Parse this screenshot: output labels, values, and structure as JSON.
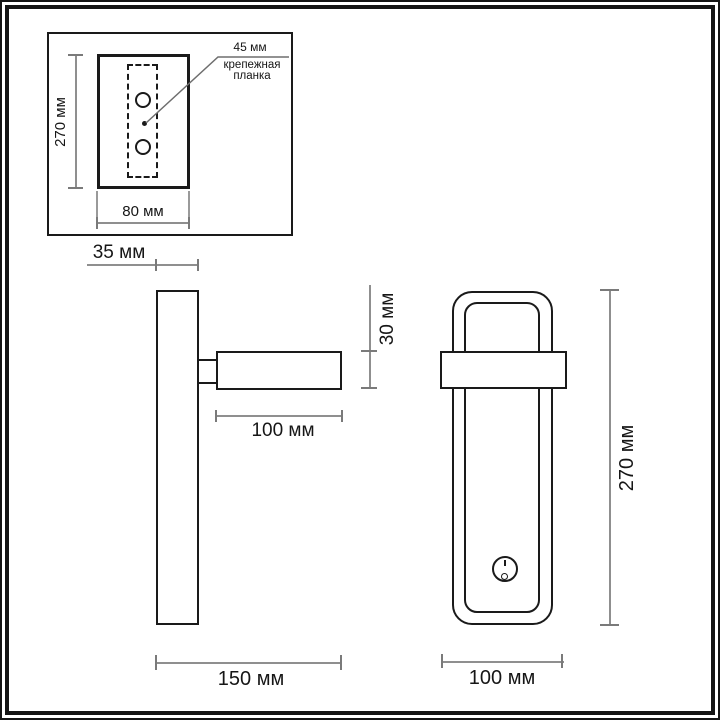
{
  "title": "wall-lamp-dimension-drawing",
  "colors": {
    "outline": "#1a1a1a",
    "dimension_line": "#8f8f8f",
    "background": "#ffffff"
  },
  "inset": {
    "callout": {
      "size": "45 мм",
      "name_line1": "крепежная",
      "name_line2": "планка"
    },
    "dim_height": "270 мм",
    "dim_width": "80 мм"
  },
  "side_view": {
    "dim_backplate_depth": "35 мм",
    "dim_head_height": "30 мм",
    "dim_head_length": "100 мм",
    "dim_total_depth": "150 мм"
  },
  "front_view": {
    "dim_height": "270 мм",
    "dim_width": "100 мм"
  }
}
